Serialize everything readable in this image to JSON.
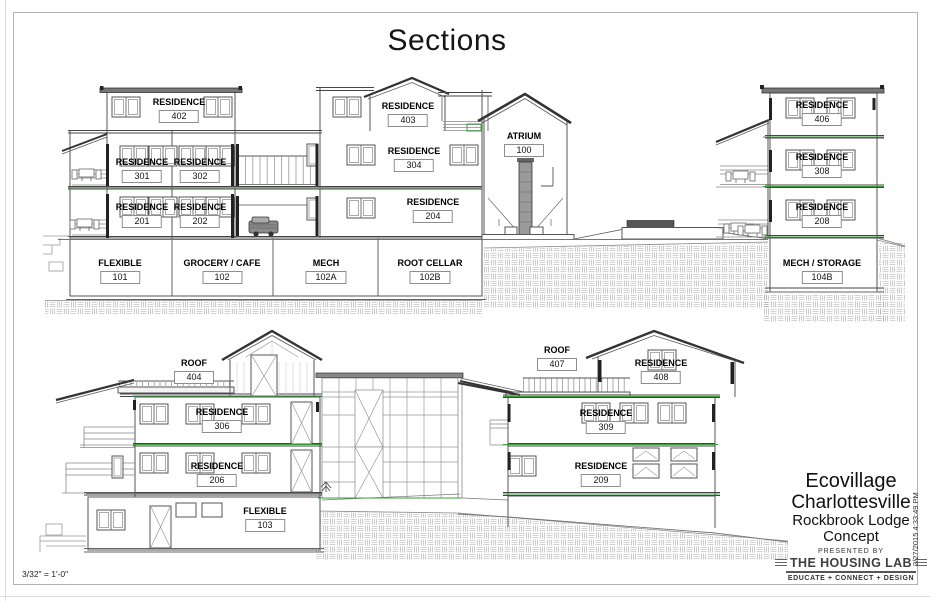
{
  "sheet": {
    "title": "Sections",
    "scale_note": "3/32\" = 1'-0\"",
    "plot_timestamp": "2/27/2015 4:33:49 PM"
  },
  "title_block": {
    "project_line1": "Ecovillage",
    "project_line2": "Charlottesville",
    "subtitle_line1": "Rockbrook Lodge",
    "subtitle_line2": "Concept",
    "presented_by": "PRESENTED BY",
    "logo": "THE HOUSING LAB",
    "tagline": "EDUCATE + CONNECT + DESIGN"
  },
  "colors": {
    "floor_level_line": "#3a9d3a"
  },
  "rooms": {
    "r402": {
      "name": "RESIDENCE",
      "number": "402"
    },
    "r403": {
      "name": "RESIDENCE",
      "number": "403"
    },
    "r301": {
      "name": "RESIDENCE",
      "number": "301"
    },
    "r302": {
      "name": "RESIDENCE",
      "number": "302"
    },
    "r304": {
      "name": "RESIDENCE",
      "number": "304"
    },
    "r100": {
      "name": "ATRIUM",
      "number": "100"
    },
    "r201": {
      "name": "RESIDENCE",
      "number": "201"
    },
    "r202": {
      "name": "RESIDENCE",
      "number": "202"
    },
    "r204": {
      "name": "RESIDENCE",
      "number": "204"
    },
    "r101": {
      "name": "FLEXIBLE",
      "number": "101"
    },
    "r102": {
      "name": "GROCERY / CAFE",
      "number": "102"
    },
    "r102a": {
      "name": "MECH",
      "number": "102A"
    },
    "r102b": {
      "name": "ROOT CELLAR",
      "number": "102B"
    },
    "r406": {
      "name": "RESIDENCE",
      "number": "406"
    },
    "r308": {
      "name": "RESIDENCE",
      "number": "308"
    },
    "r208": {
      "name": "RESIDENCE",
      "number": "208"
    },
    "r104b": {
      "name": "MECH / STORAGE",
      "number": "104B"
    },
    "r404": {
      "name": "ROOF",
      "number": "404"
    },
    "r306": {
      "name": "RESIDENCE",
      "number": "306"
    },
    "r206": {
      "name": "RESIDENCE",
      "number": "206"
    },
    "r103": {
      "name": "FLEXIBLE",
      "number": "103"
    },
    "r407": {
      "name": "ROOF",
      "number": "407"
    },
    "r408": {
      "name": "RESIDENCE",
      "number": "408"
    },
    "r309": {
      "name": "RESIDENCE",
      "number": "309"
    },
    "r209": {
      "name": "RESIDENCE",
      "number": "209"
    }
  }
}
